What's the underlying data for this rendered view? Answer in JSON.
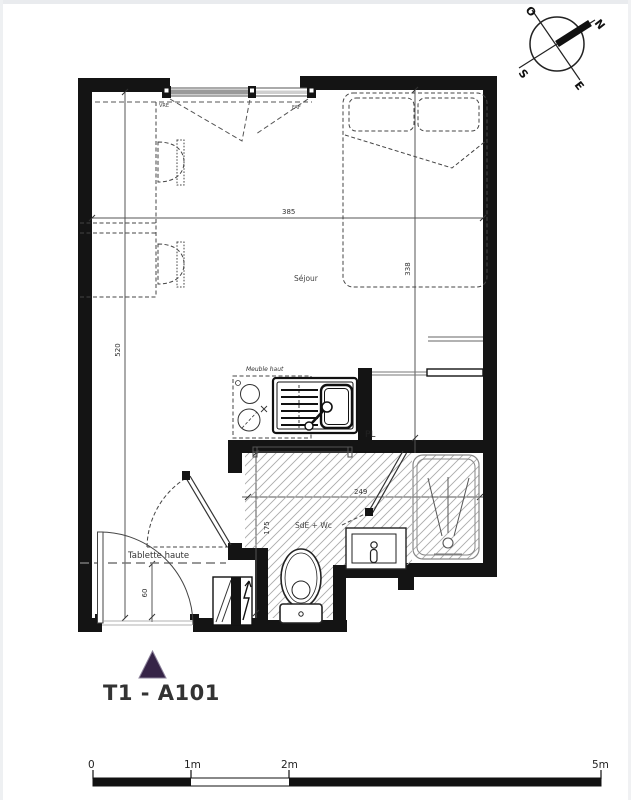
{
  "meta": {
    "accent_color": "#362447",
    "wall_color": "#141414",
    "hatch_color": "#ababab"
  },
  "compass": {
    "north": "N",
    "south": "S",
    "east": "E",
    "west": "O"
  },
  "plan": {
    "rooms": {
      "sejour": "Séjour",
      "bathroom": "SdE + Wc",
      "closet": "PL"
    },
    "labels": {
      "meuble_haut": "Meuble haut",
      "tablette_haute": "Tablette haute",
      "window_left": "VRE",
      "window_right": "FAF"
    },
    "dimensions": {
      "sejour_width": "385",
      "bed_area_depth": "338",
      "sejour_length": "520",
      "bathroom_width": "249",
      "bathroom_depth": "175",
      "entry_shelf_width": "60"
    }
  },
  "title": {
    "label": "T1 - A101"
  },
  "scale_bar": {
    "tick_0": "0",
    "tick_1": "1m",
    "tick_2": "2m",
    "tick_5": "5m"
  }
}
